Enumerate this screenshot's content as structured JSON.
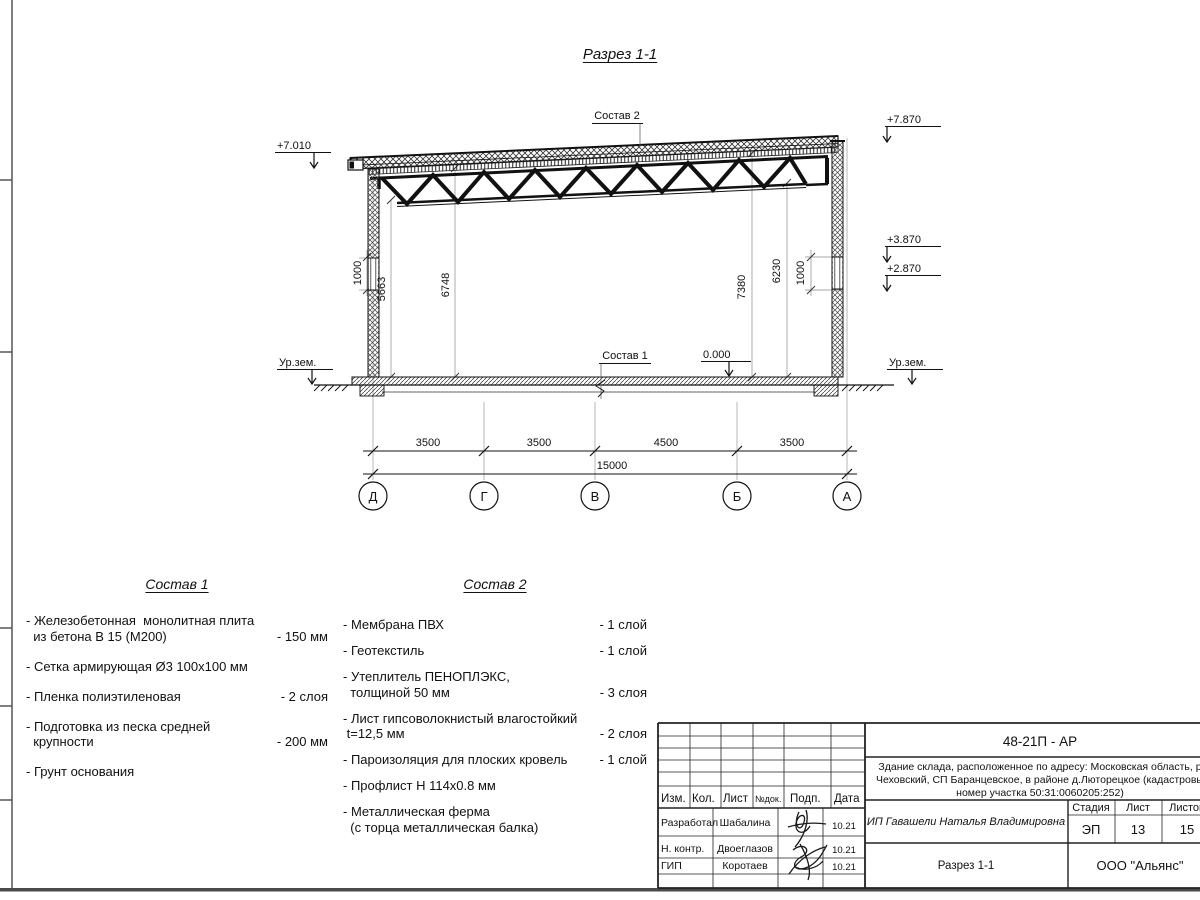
{
  "title": "Разрез 1-1",
  "colors": {
    "ink": "#111111",
    "aux_line": "#888888",
    "frame": "#4a4a4a",
    "paper": "#ffffff"
  },
  "drawing": {
    "labels": {
      "sostav1_ref": "Состав 1",
      "sostav2_ref": "Состав 2"
    },
    "elevations": {
      "left_top": "+7.010",
      "right_top": "+7.870",
      "right_upper": "+3.870",
      "right_lower": "+2.870",
      "zero": "0.000",
      "ground": "Ур.зем."
    },
    "vertical_dims": [
      "1000",
      "5663",
      "6748",
      "7380",
      "6230",
      "1000"
    ],
    "axis_dims": [
      "3500",
      "3500",
      "4500",
      "3500"
    ],
    "total_dim": "15000",
    "axes": [
      "Д",
      "Г",
      "В",
      "Б",
      "А"
    ]
  },
  "sostav1": {
    "heading": "Состав 1",
    "items": [
      {
        "name": "- Железобетонная  монолитная плита\n  из бетона В 15 (М200)",
        "value": "- 150 мм"
      },
      {
        "name": "- Сетка армирующая Ø3 100х100 мм",
        "value": ""
      },
      {
        "name": "- Пленка полиэтиленовая",
        "value": "-  2 слоя"
      },
      {
        "name": "- Подготовка из песка средней\n  крупности",
        "value": "- 200 мм"
      },
      {
        "name": "- Грунт основания",
        "value": ""
      }
    ]
  },
  "sostav2": {
    "heading": "Состав 2",
    "items": [
      {
        "name": "- Мембрана ПВХ",
        "value": "- 1 слой"
      },
      {
        "name": "- Геотекстиль",
        "value": "- 1 слой"
      },
      {
        "name": "- Утеплитель ПЕНОПЛЭКС,\n  толщиной 50 мм",
        "value": "- 3 слоя"
      },
      {
        "name": "- Лист гипсоволокнистый влагостойкий\n t=12,5 мм",
        "value": "- 2 слоя"
      },
      {
        "name": "- Пароизоляция для плоских кровель",
        "value": "- 1 слой"
      },
      {
        "name": "- Профлист Н 114х0.8 мм",
        "value": ""
      },
      {
        "name": "- Металлическая ферма\n  (с торца металлическая балка)",
        "value": ""
      }
    ]
  },
  "title_block": {
    "doc_code": "48-21П - АР",
    "description_lines": [
      "Здание склада, расположенное по адресу: Московская область, р",
      "Чеховский, СП Баранцевское, в районе д.Люторецкое  (кадастровы",
      "номер участка 50:31:0060205:252)"
    ],
    "header_cols": {
      "izm": "Изм.",
      "kol": "Кол.",
      "list": "Лист",
      "ndok": "№док.",
      "podp": "Подп.",
      "data": "Дата"
    },
    "rows": [
      {
        "role": "Разработал",
        "name": "Шабалина",
        "date": "10.21"
      },
      {
        "role": "Н. контр.",
        "name": "Двоеглазов",
        "date": "10.21"
      },
      {
        "role": "ГИП",
        "name": "Коротаев",
        "date": "10.21"
      }
    ],
    "client": "ИП Гавашели Наталья Владимировна",
    "stage_label": "Стадия",
    "sheet_label": "Лист",
    "sheets_label": "Листов",
    "stage": "ЭП",
    "sheet": "13",
    "sheets": "15",
    "sheet_title": "Разрез 1-1",
    "company": "ООО \"Альянс\""
  }
}
